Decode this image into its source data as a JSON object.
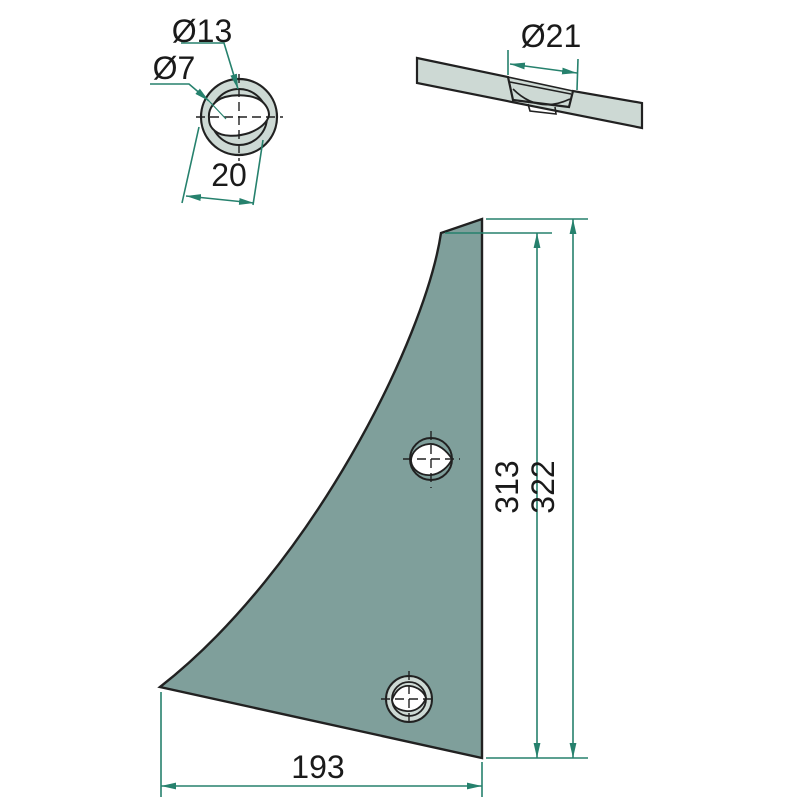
{
  "colors": {
    "outline": "#212121",
    "plate": "#7f9f9b",
    "light": "#cdd9d4",
    "dim": "#26816d",
    "text": "#1a1a1a",
    "bg": "#ffffff"
  },
  "hub_view": {
    "bore_label": "Ø13",
    "square_label": "Ø7",
    "od_label": "20"
  },
  "section_view": {
    "countersink_label": "Ø21"
  },
  "profile_view": {
    "height_inner_label": "313",
    "height_outer_label": "322",
    "width_label": "193"
  }
}
